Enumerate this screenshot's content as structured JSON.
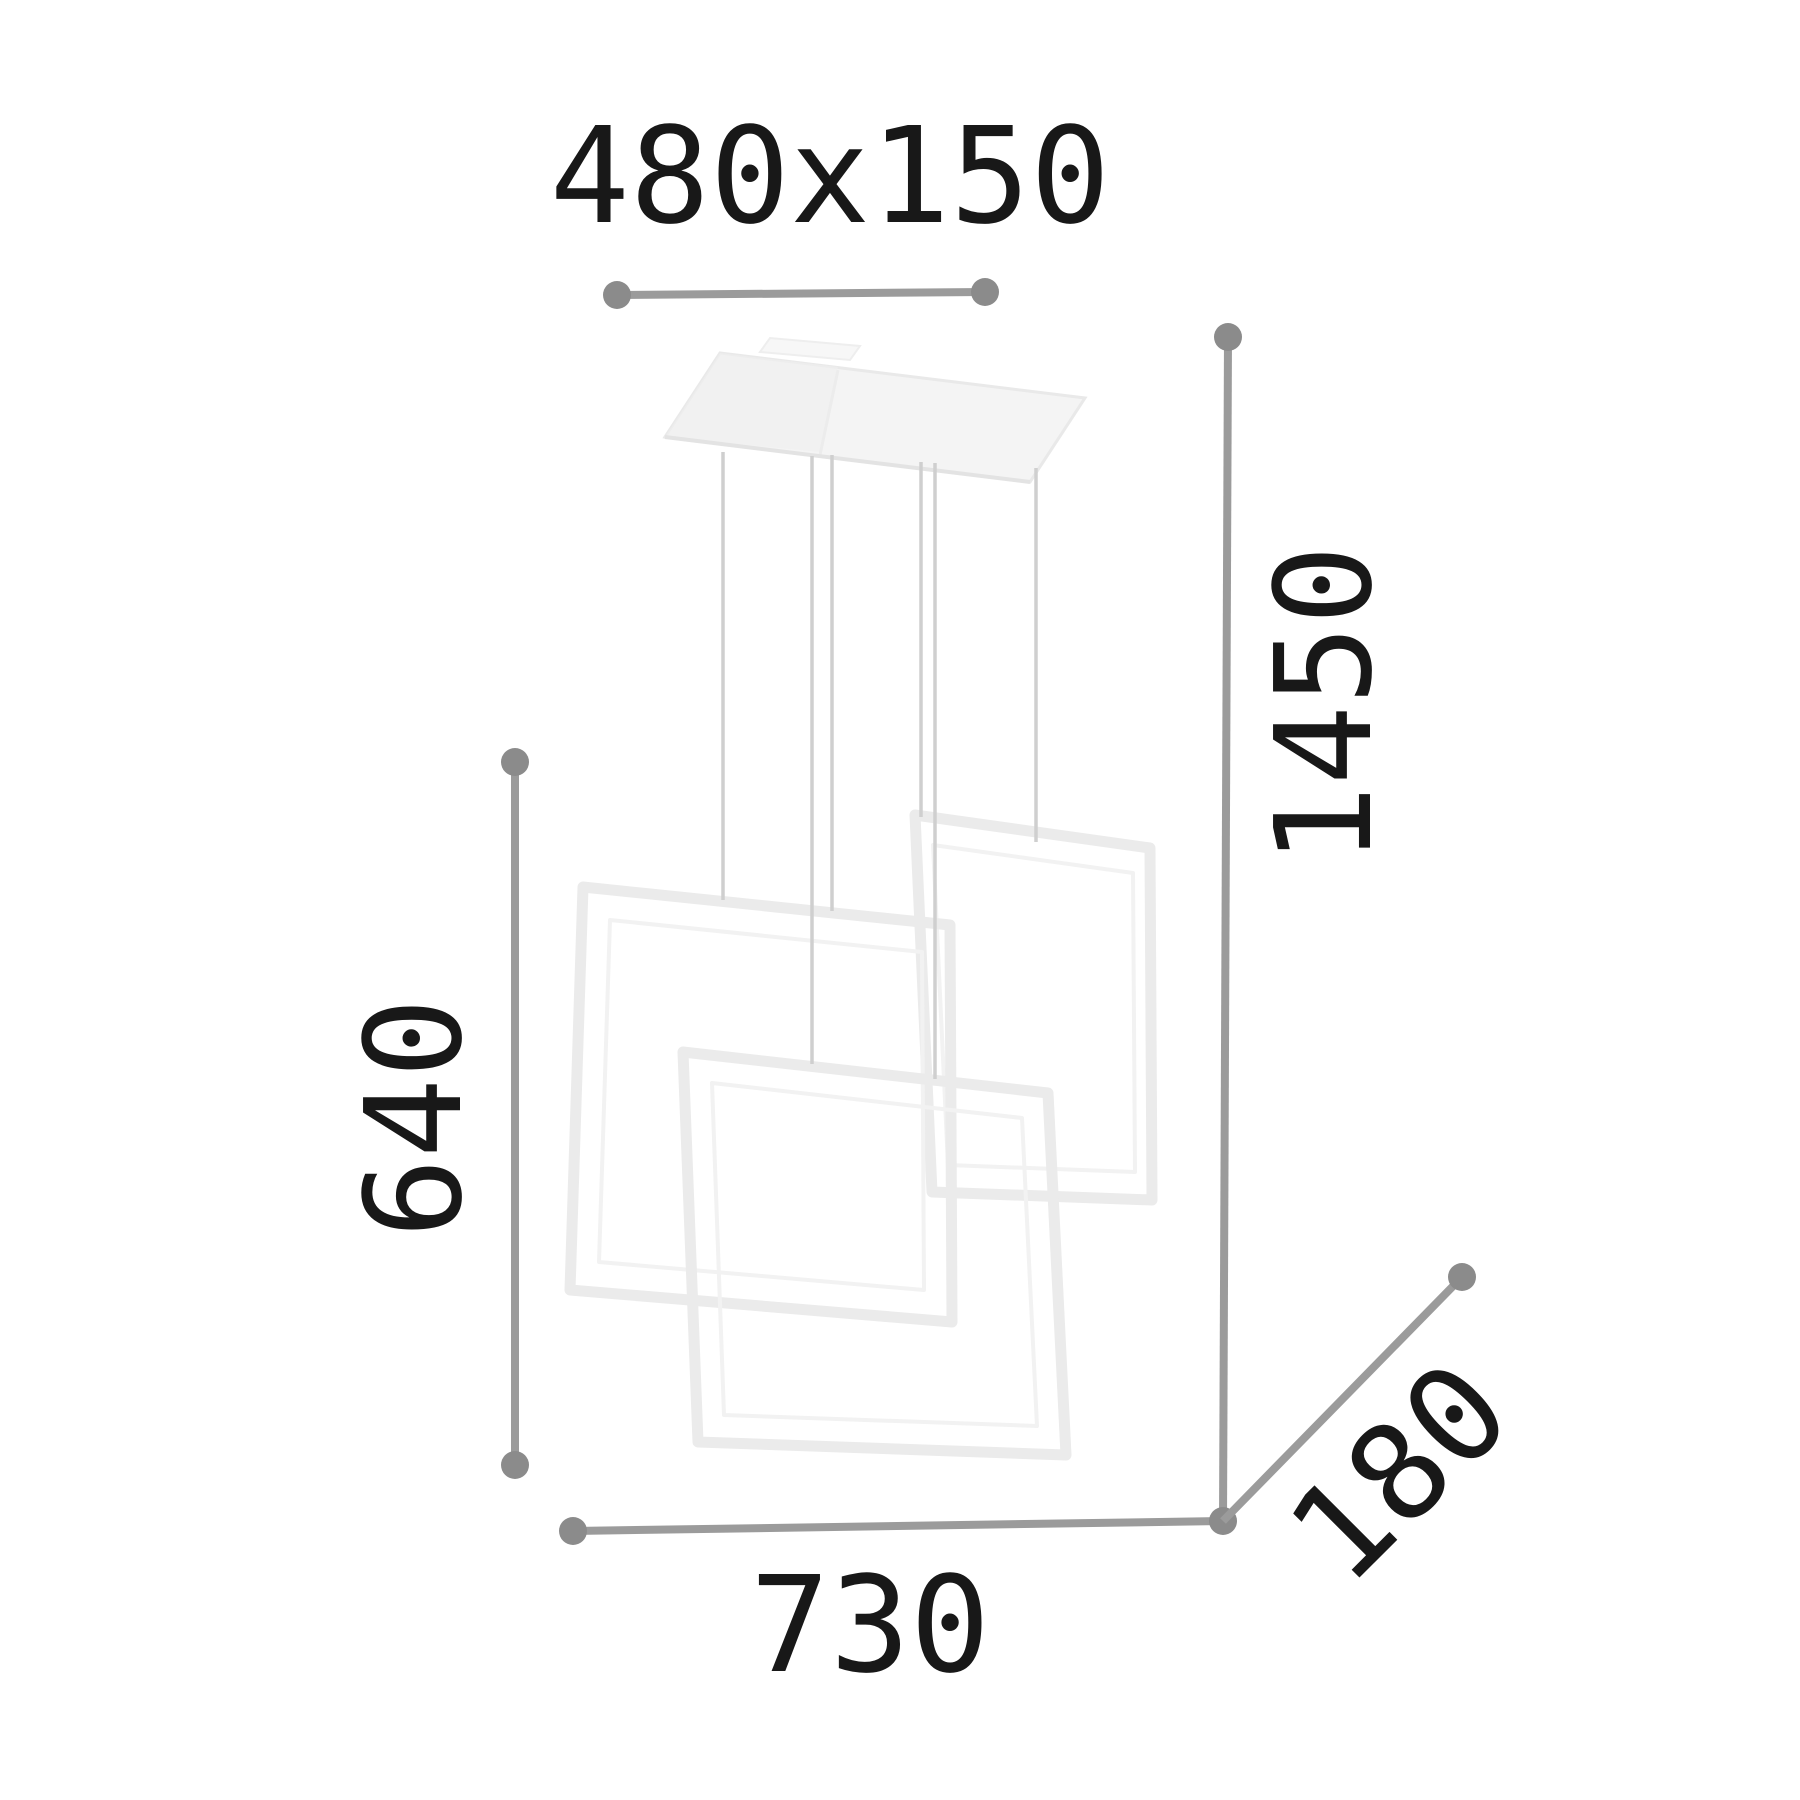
{
  "meta": {
    "title": "Pendant lamp technical dimension drawing",
    "drawing_type": "dimension-diagram",
    "subject": "pendant light with three overlapping square frames"
  },
  "dimensions": {
    "canopy": {
      "label": "480x150",
      "meaning": "ceiling canopy width x depth"
    },
    "total_height": {
      "label": "1450",
      "meaning": "maximum suspension height"
    },
    "fixture_height": {
      "label": "640",
      "meaning": "height of square frames section"
    },
    "width": {
      "label": "730",
      "meaning": "overall fixture width"
    },
    "depth": {
      "label": "180",
      "meaning": "overall fixture depth"
    }
  },
  "colors": {
    "background": "#ffffff",
    "dimension_line": "#9b9b9b",
    "dimension_dot": "#8b8b8b",
    "label_text": "#181818",
    "lamp_outline": "#ebebeb",
    "lamp_outline_inner": "#f2f2f2",
    "canopy_fill": "#f4f4f4",
    "wire": "#cfcfcf"
  }
}
